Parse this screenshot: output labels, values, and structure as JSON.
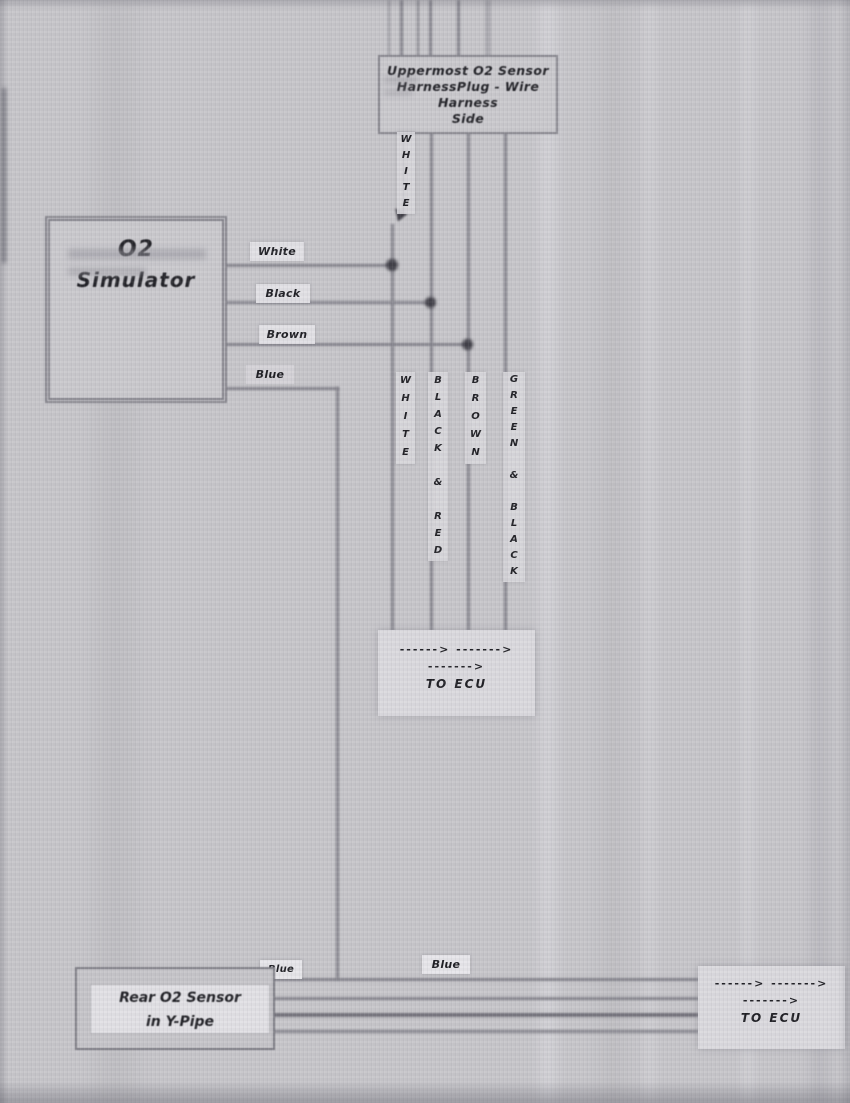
{
  "palette": {
    "paper": "#c7c6ca",
    "ink": "#1f1f24",
    "wire": "#84838b"
  },
  "boxes": {
    "top_connector": {
      "lines": [
        "Uppermost O2 Sensor",
        "HarnessPlug - Wire",
        "Harness",
        "Side"
      ]
    },
    "simulator": {
      "lines": [
        "O2",
        "Simulator"
      ]
    },
    "rear_sensor": {
      "lines": [
        "Rear O2 Sensor",
        "in Y-Pipe"
      ]
    },
    "ecu_mid": {
      "arrow_line1": "------>  ------->",
      "arrow_line2": "------->",
      "label": "TO ECU"
    },
    "ecu_right": {
      "arrow_line1": "------>  ------->",
      "arrow_line2": "------->",
      "label": "TO ECU"
    }
  },
  "wire_tags": {
    "white": "White",
    "black": "Black",
    "brown": "Brown",
    "blue_sim": "Blue",
    "blue_mid": "Blue",
    "blue_rear": "Blue"
  },
  "vertical_tags": {
    "white_top": {
      "text": "WHITE",
      "stacked": "W\nH\nI\nT\nE"
    },
    "white": {
      "text": "WHITE",
      "stacked": "W\nH\nI\nT\nE"
    },
    "black_red": {
      "text": "BLACK & RED",
      "stacked": "B\nL\nA\nC\nK\n \n&\n \nR\nE\nD"
    },
    "brown": {
      "text": "BROWN",
      "stacked": "B\nR\nO\nW\nN"
    },
    "green_black": {
      "text": "GREEN & BLACK",
      "stacked": "G\nR\nE\nE\nN\n \n&\n \nB\nL\nA\nC\nK"
    }
  }
}
